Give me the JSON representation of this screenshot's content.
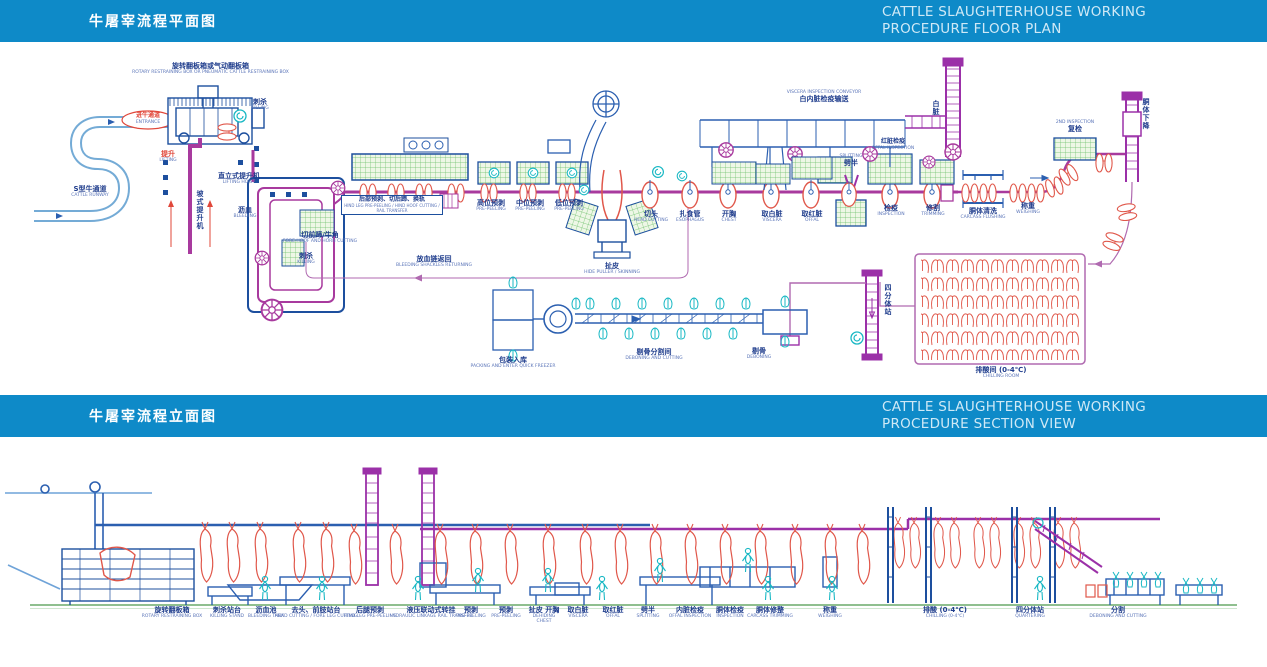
{
  "colors": {
    "header_bg": "#0e8ac8",
    "rail_magenta": "#a83a9e",
    "machine_blue": "#1d4f9e",
    "runway_blue": "#74abd6",
    "cyan": "#19b8c4",
    "carcass_red": "#e0574a",
    "grid_green": "#6abf69",
    "ground_green": "#8fbf8f"
  },
  "header_floor_plan": {
    "title_cn": "牛屠宰流程平面图",
    "title_en_1": "CATTLE SLAUGHTERHOUSE WORKING",
    "title_en_2": "PROCEDURE FLOOR PLAN"
  },
  "header_section_view": {
    "title_cn": "牛屠宰流程立面图",
    "title_en_1": "CATTLE SLAUGHTERHOUSE WORKING",
    "title_en_2": "PROCEDURE SECTION VIEW"
  },
  "floor_plan": {
    "labels": [
      {
        "cn": "旋转翻板箱或气动翻板箱",
        "en": "ROTARY RESTRAINING BOX OR PNEUMATIC CATTLE RESTRAINING BOX"
      },
      {
        "cn": "进牛通道",
        "en": "ENTRANCE"
      },
      {
        "cn": "S型牛通道",
        "en": "CATTLE RUNWAY"
      },
      {
        "cn": "刺杀",
        "en": "KILLING"
      },
      {
        "cn": "提升",
        "en": "LIFTING"
      },
      {
        "cn": "直立式提升机",
        "en": "LIFTING HOIST"
      },
      {
        "cn": "坡式提升机",
        "en": ""
      },
      {
        "cn": "沥血",
        "en": "BLEEDING"
      },
      {
        "cn": "切前蹄/牛角",
        "en": "FORE HOOF AND HORN CUTTING"
      },
      {
        "cn": "刺杀",
        "en": "KILLING"
      },
      {
        "cn": "后部预剥、切后蹄、换轨",
        "en": "HIND LEG PRE-PEELING / HIND HOOF CUTTING / RAIL TRANSFER"
      },
      {
        "cn": "放血链返回",
        "en": "BLEEDING SHACKLES RETURNING"
      },
      {
        "cn": "高位预剥",
        "en": "PRE-PEELING"
      },
      {
        "cn": "中位预剥",
        "en": "PRE-PEELING"
      },
      {
        "cn": "低位预剥",
        "en": "PRE-PEELING"
      },
      {
        "cn": "扯皮",
        "en": "HIDE PULLER / SKINNING"
      },
      {
        "cn": "切头",
        "en": "HEAD CUTTING"
      },
      {
        "cn": "扎食管",
        "en": "ESOPHAGUS"
      },
      {
        "cn": "开胸",
        "en": "CHEST"
      },
      {
        "cn": "取白脏",
        "en": "VISCERA"
      },
      {
        "cn": "取红脏",
        "en": "OFFAL"
      },
      {
        "cn": "劈半",
        "en": "SPLITTING"
      },
      {
        "cn": "检疫",
        "en": "INSPECTION"
      },
      {
        "cn": "修割",
        "en": "TRIMMING"
      },
      {
        "cn": "白内脏检疫输送",
        "en": "VISCERA INSPECTION CONVEYOR"
      },
      {
        "cn": "红脏检疫",
        "en": "OFFAL INSPECTION"
      },
      {
        "cn": "白脏",
        "en": ""
      },
      {
        "cn": "复检",
        "en": "2ND INSPECTION"
      },
      {
        "cn": "胴体下降",
        "en": ""
      },
      {
        "cn": "胴体清洗",
        "en": "CARCASS FLUSHING"
      },
      {
        "cn": "称重",
        "en": "WEIGHING"
      },
      {
        "cn": "排酸间 (0-4℃)",
        "en": "CHILLING ROOM"
      },
      {
        "cn": "四分体站",
        "en": ""
      },
      {
        "cn": "剔骨",
        "en": "DEBONING"
      },
      {
        "cn": "剔骨分割间",
        "en": "DEBONING AND CUTTING"
      },
      {
        "cn": "包装入库",
        "en": "PACKING AND ENTER QUICK FREEZER"
      }
    ]
  },
  "section_view": {
    "labels": [
      {
        "cn": "旋转翻板箱",
        "en": "ROTARY RESTRAINING BOX"
      },
      {
        "cn": "刺杀站台",
        "en": "KILLING STAND"
      },
      {
        "cn": "沥血池",
        "en": "BLEEDING TANK"
      },
      {
        "cn": "去头、前肢站台",
        "en": "HEAD CUTTING / FORE LEG CUTTING"
      },
      {
        "cn": "后腿预剥",
        "en": "HIND LEG PRE-PEELING"
      },
      {
        "cn": "液压联动式转挂",
        "en": "HYDRAULIC LINKAGE RAIL TRANSFER"
      },
      {
        "cn": "预剥",
        "en": "PRE-PEELING"
      },
      {
        "cn": "预剥",
        "en": "PRE-PEELING"
      },
      {
        "cn": "扯皮 开胸",
        "en": "DEHIDING CHEST"
      },
      {
        "cn": "取白脏",
        "en": "VISCERA"
      },
      {
        "cn": "取红脏",
        "en": "OFFAL"
      },
      {
        "cn": "劈半",
        "en": "SPLITTING"
      },
      {
        "cn": "内脏检疫",
        "en": "OFFAL INSPECTION"
      },
      {
        "cn": "胴体检疫",
        "en": "INSPECTION"
      },
      {
        "cn": "胴体修整",
        "en": "CARCASS TRIMMING"
      },
      {
        "cn": "称重",
        "en": "WEIGHING"
      },
      {
        "cn": "排酸 (0-4℃)",
        "en": "CHILLING (0-4℃)"
      },
      {
        "cn": "四分体站",
        "en": "QUARTERING"
      },
      {
        "cn": "分割",
        "en": "DEBONING AND CUTTING"
      }
    ]
  }
}
